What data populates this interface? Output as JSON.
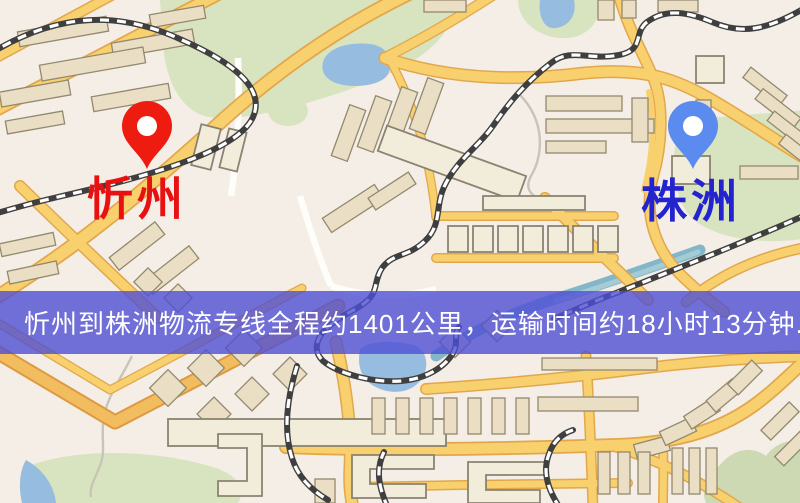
{
  "meta": {
    "type": "logistics-route-map"
  },
  "banner": {
    "text": "忻州到株洲物流专线全程约1401公里，运输时间约18小时13分钟.",
    "background": "#4f4fd5",
    "text_color": "#ffffff"
  },
  "markers": {
    "origin": {
      "label": "忻州",
      "pin_icon": "map-pin",
      "pin_color": "#ee1c10",
      "pin_hole_color": "#ffffff",
      "label_color": "#e81111"
    },
    "destination": {
      "label": "株洲",
      "pin_icon": "map-pin",
      "pin_color": "#5b8bee",
      "pin_hole_color": "#ffffff",
      "label_color": "#2424cf"
    }
  },
  "route": {
    "distance_text": "约1401公里",
    "duration_text": "约18小时13分钟"
  },
  "map_palette": {
    "background": "#f4eee6",
    "road_fill": "#f8d06e",
    "road_casing": "#e2a74c",
    "water": "#96bcdf",
    "park": "#d8e3bf",
    "building": "#eadfc5",
    "railway_dark": "#3f3f3f",
    "railway_light": "#ffffff"
  }
}
